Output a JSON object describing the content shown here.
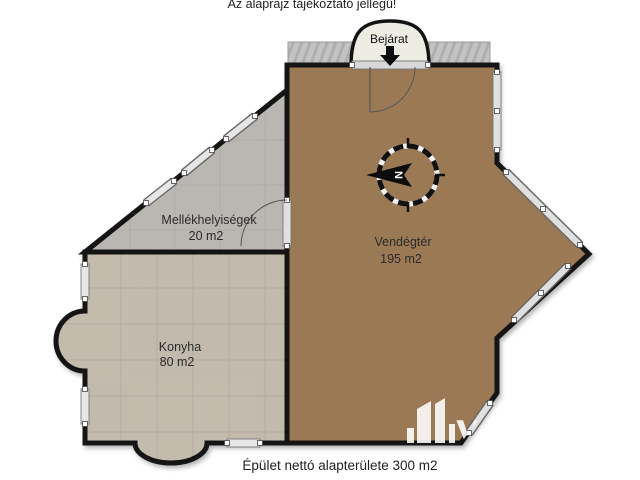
{
  "header": {
    "notice": "Az alaprajz tájékoztató jellegű!"
  },
  "entrance": {
    "label": "Bejárat"
  },
  "rooms": {
    "restrooms": {
      "name": "Mellékhelyiségek",
      "area": "20 m2",
      "floor_color": "#c9c5c0"
    },
    "guest_area": {
      "name": "Vendégtér",
      "area": "195 m2",
      "floor_color": "#a7835c"
    },
    "kitchen": {
      "name": "Konyha",
      "area": "80 m2",
      "floor_color": "#d2cbbb"
    }
  },
  "compass": {
    "north_letter": "N"
  },
  "watermark": {
    "letter": "y"
  },
  "footer": {
    "total_area_text": "Épület nettó alapterülete 300 m2"
  },
  "colors": {
    "wall": "#141414",
    "terrace": "#c3c3c3",
    "arch_fill": "#edece3",
    "window_fill": "#e0e0e0"
  }
}
